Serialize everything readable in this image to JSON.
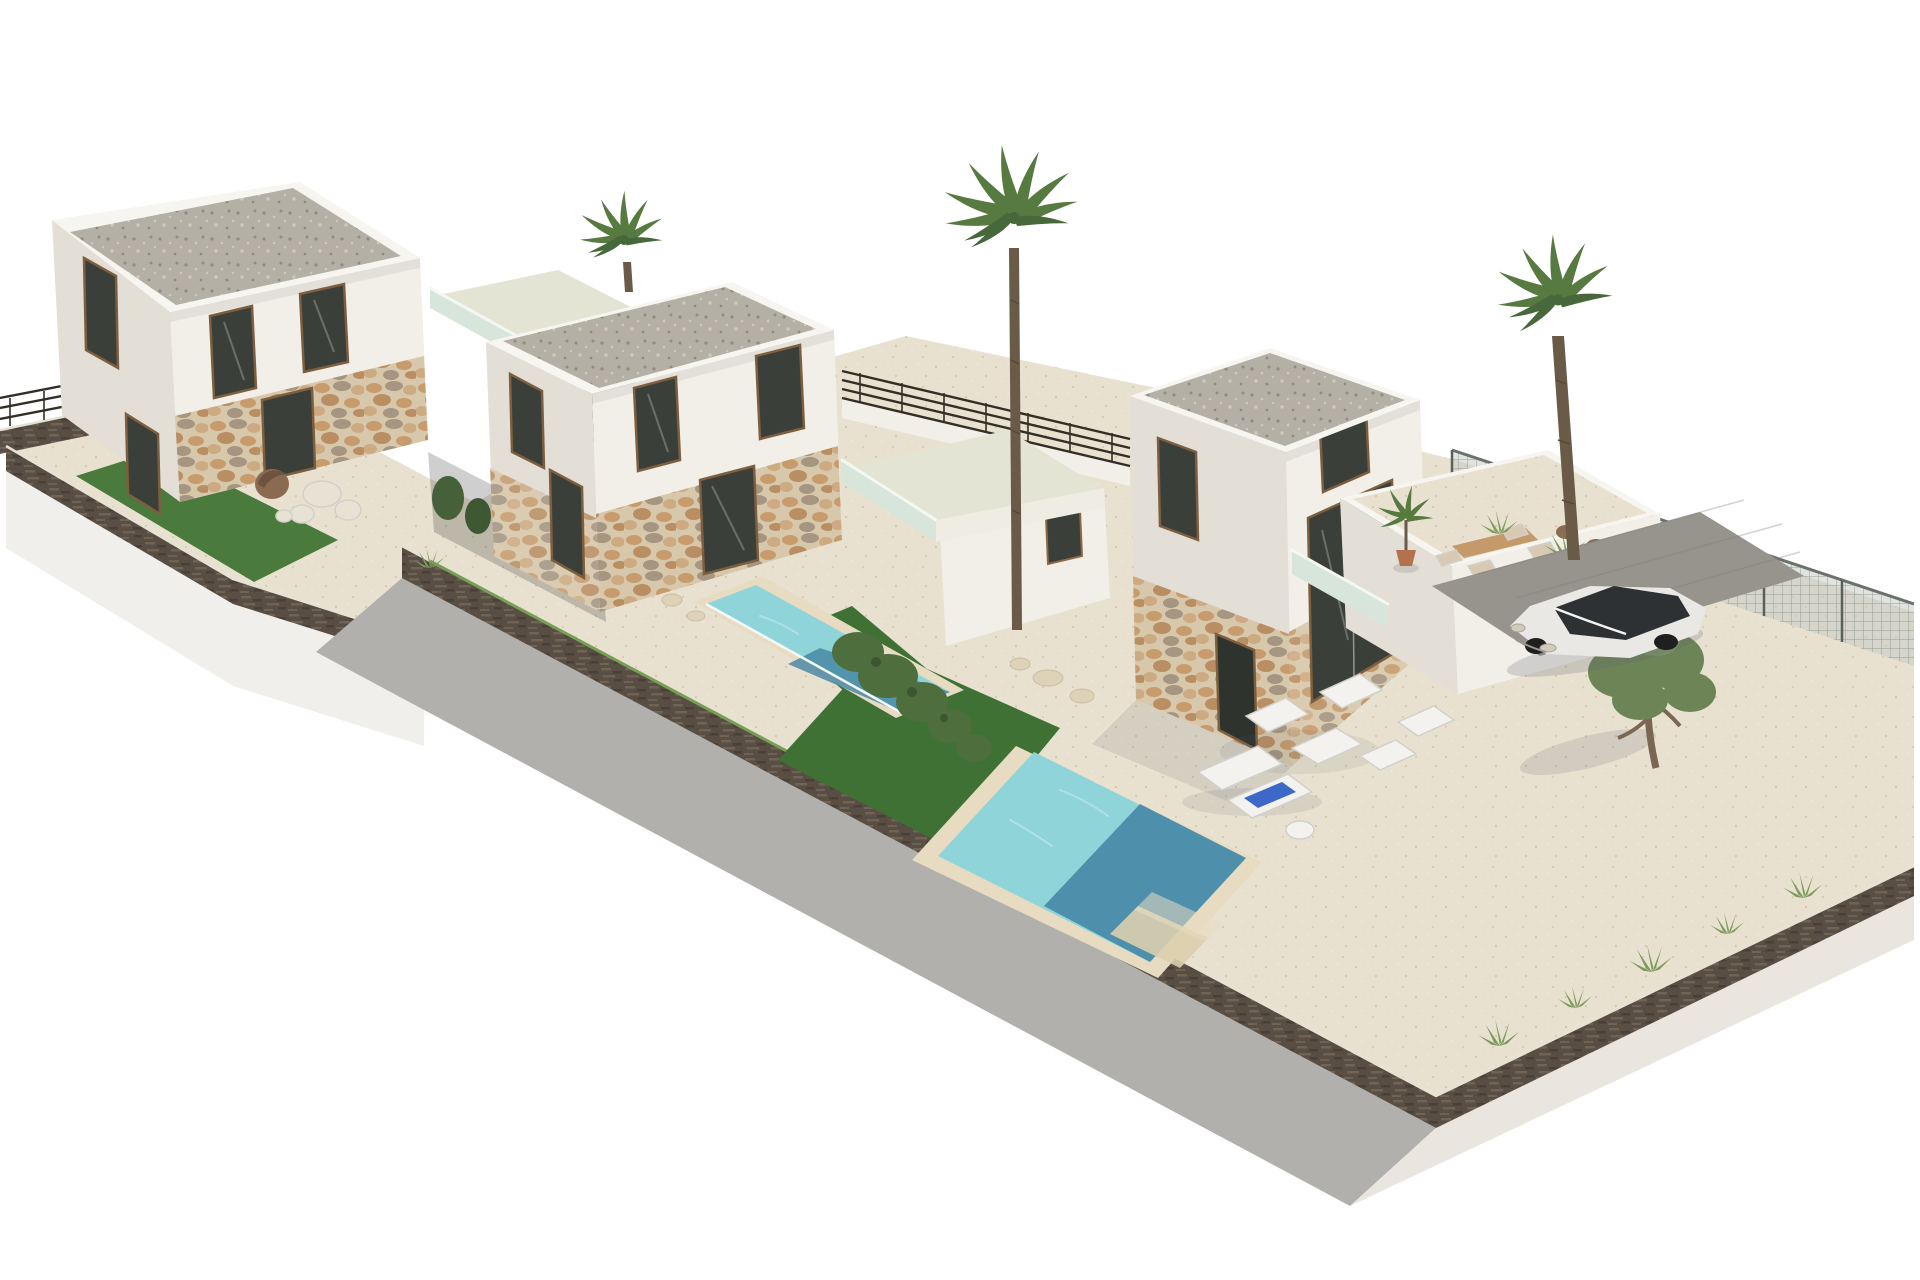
{
  "scene": {
    "description": "Aerial 3D architectural rendering of three modern two-storey white villas with flat gravel roofs, stone-clad ground floors, glass balconies, private pools, lawns, palm trees and a parked white SUV on a walled corner plot, on a plain white background",
    "inventory": {
      "villas": 3,
      "roof_terraces": 3,
      "pools": 2,
      "lawns": 3,
      "palm_trees": 3,
      "potted_palms": 1,
      "olive_trees": 1,
      "sun_loungers": 2,
      "lounge_chairs": 4,
      "dining_chairs": 4,
      "decor_stones": 5,
      "cars": 1
    }
  },
  "palette": {
    "background": "#ffffff",
    "wall_front": "#f2efe8",
    "wall_side": "#e3dfd6",
    "wall_top": "#f7f5f0",
    "parapet": "#efece4",
    "roof_gravel_base": "#b5b0a6",
    "roof_gravel_dot1": "#918c81",
    "roof_gravel_dot2": "#cfc9bc",
    "stone_base": "#d8c8ab",
    "stone_blob1": "#c79b6c",
    "stone_blob2": "#b98e62",
    "stone_blob3": "#cdab82",
    "stone_gray": "#a59581",
    "sand_base": "#e9e1d0",
    "sand_dot1": "#d5c7ac",
    "sand_dot2": "#f0e9da",
    "terrace_sage": "#e3e4d3",
    "glass_balcony": "#d7e5da",
    "window_glass": "#3a3f39",
    "door_dark": "#2f332d",
    "lawn_bright": "#4a7a3c",
    "lawn_deep": "#3f7134",
    "pool_light": "#8fd4d8",
    "pool_deep": "#4383a3",
    "pool_coping": "#e7dcc1",
    "gabion_base": "#584e43",
    "gabion_streak1": "#6e6355",
    "gabion_streak2": "#4a4038",
    "plinth_shade": "#b2b0ac",
    "plinth_warm": "#eae6df",
    "plinth_light": "#f1efeb",
    "mesh_fill": "#c6ccc6",
    "mesh_line": "#868f87",
    "pad_gray": "#97948d",
    "car_body": "#e9e8e4",
    "car_glass": "#2e3134",
    "wheel": "#1f1f1f",
    "palm_trunk": "#6a5a48",
    "palm_leaf": "#567a40",
    "palm_leaf_dark": "#47683a",
    "olive_leaf": "#6d8556",
    "olive_trunk": "#7a6753",
    "bush_green": "#4e6e3e",
    "tuft_green": "#7d9a5c",
    "shadow": "#5a6070",
    "towel_blue": "#3e68c8",
    "furniture_white": "#f3f2ee",
    "furniture_wood": "#c59a6b",
    "pot_terracotta": "#b4714e",
    "stone_decor": "#e8e2d4",
    "cocoon_brown": "#8a6a50"
  }
}
